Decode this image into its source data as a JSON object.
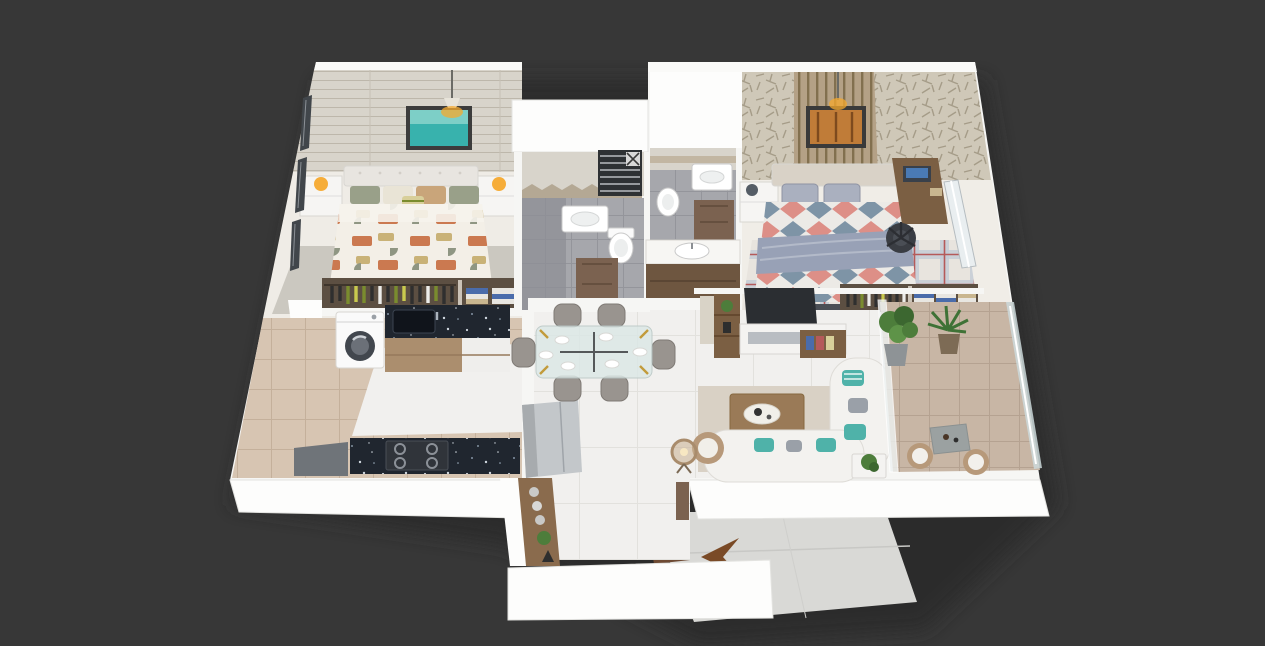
{
  "scene": {
    "kind": "isometric-3d-floor-plan-render",
    "apartment": "two-bedroom-apartment",
    "background": "#373737",
    "entry_arrow": {
      "glyph": "left-chevron-arrow",
      "color": "#7a4a26",
      "direction": "left"
    }
  },
  "palette": {
    "backdrop": "#373737",
    "shadow": "#2b2b2b",
    "wall_top": "#f6f6f4",
    "wall_face": "#fdfdfc",
    "floor_white": "#f1f0ee",
    "floor_beige": "#d7c5b2",
    "bath_tile": "#a6a7ac",
    "bath_tile_dark": "#8e8f95",
    "bath_wall_tile": "#d8d4cb",
    "balcony_tile": "#c8b6a5",
    "walkway": "#d9d9d6",
    "granite": "#20262f",
    "wood_cabinet": "#ab8e6e",
    "wood_dark": "#7b5f43",
    "door_wood": "#7b6250",
    "vanity_wood": "#6e5640",
    "wardrobe_interior": "#5c4f42",
    "accent_teal": "#4fb2a9",
    "lamp_glow": "#f6a92e",
    "plant_green": "#4d7d3b",
    "plant_dark": "#3c6730",
    "arrow_brown": "#7a4a26",
    "plank_wall": "#d8d4cb",
    "wallpaper": "#cfc8b8",
    "slat_panel": "#b4a186",
    "picture_teal": "#38b2ad",
    "picture_orange": "#c07c38",
    "duvet_terracotta": "#cb7950",
    "duvet_tan": "#c9b277",
    "duvet_sage": "#8f9683",
    "duvet_blue": "#7e94a6",
    "duvet_coral": "#dd8f87",
    "blanket_gray": "#98a1b6",
    "rug_gray": "#cbc8c0",
    "rug_living": "#d9d1c5",
    "sofa_white": "#f3f2ef",
    "rattan": "#b7997a",
    "fridge_gray": "#c3c7ca",
    "tv_dark": "#2b2e32",
    "office_chair": "#3a3d43",
    "washer_door": "#42474e",
    "stack_blue": "#4a6cab",
    "gold": "#c29b3c"
  },
  "rooms": {
    "master_bedroom": {
      "label": "master-bedroom",
      "items": [
        "double-bed",
        "tufted-headboard",
        "patterned-duvet",
        "nightstand-left",
        "nightstand-right",
        "orange-table-lamps",
        "teal-wall-art",
        "pendant-light",
        "plank-accent-wall",
        "gray-area-rug",
        "open-wardrobe",
        "window-wall"
      ]
    },
    "bathroom_common": {
      "label": "common-bathroom",
      "items": [
        "towel-warmer",
        "wash-basin",
        "toilet",
        "chevron-tile-band",
        "shower-corner",
        "wood-door"
      ]
    },
    "bathroom_attached": {
      "label": "attached-bathroom",
      "items": [
        "wash-basin",
        "toilet",
        "wood-door",
        "vanity-counter-basin"
      ]
    },
    "second_bedroom": {
      "label": "second-bedroom",
      "items": [
        "double-bed",
        "geometric-duvet",
        "gray-pillows",
        "study-desk",
        "laptop",
        "office-chair",
        "autumn-wall-art",
        "pendant-light",
        "slat-accent-panel",
        "plaid-rug",
        "open-wardrobe",
        "window-wall",
        "foot-bench"
      ]
    },
    "kitchen": {
      "label": "kitchen",
      "items": [
        "washing-machine",
        "granite-counter-sink",
        "granite-counter-hob",
        "base-cabinets",
        "beige-tile-floor"
      ]
    },
    "dining": {
      "label": "dining-area",
      "items": [
        "glass-dining-table",
        "six-chairs",
        "dinner-plates",
        "refrigerator"
      ]
    },
    "living_room": {
      "label": "living-room",
      "items": [
        "tv-panel",
        "media-console",
        "shelf-tower",
        "curved-sofa",
        "teal-cushions",
        "coffee-table",
        "area-rug",
        "floor-lamp",
        "rattan-armchair",
        "side-table-plant"
      ]
    },
    "balcony": {
      "label": "balcony",
      "items": [
        "glass-railing",
        "fiddle-leaf-plant",
        "palm-plant",
        "bistro-table",
        "two-rattan-chairs",
        "beige-tile-floor"
      ]
    },
    "foyer": {
      "label": "entrance-foyer",
      "items": [
        "decor-console",
        "vases",
        "eiffel-figurine",
        "entry-walkway",
        "entry-arrow",
        "open-door"
      ]
    }
  }
}
